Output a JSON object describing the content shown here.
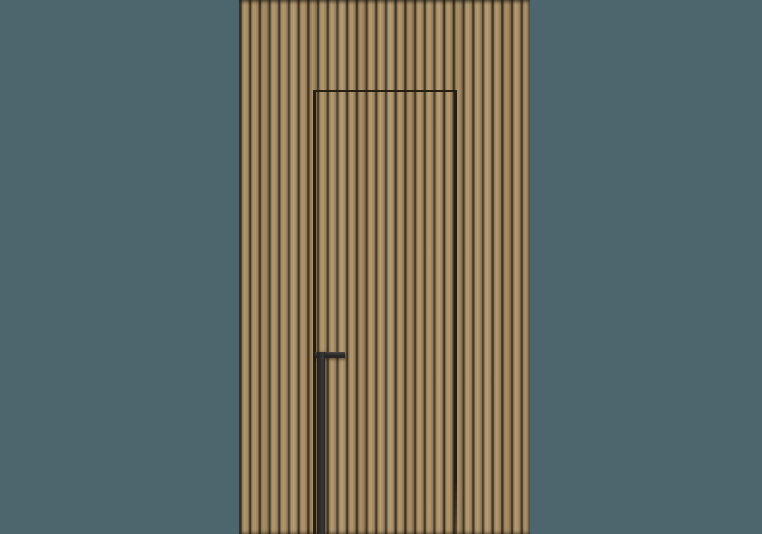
{
  "meta": {
    "description": "Product render of a concealed flush interior door clad in vertical wood slats, with a full-height matte black handle profile, set in a wood slat wall panel on a plain slate-teal background"
  },
  "colors": {
    "wall_background": "#4d666d",
    "wood_light": "#b2976d",
    "wood_base": "#a3885e",
    "wood_dark": "#8a7150",
    "groove_mid": "#7a6749",
    "groove_dark": "#3e3320",
    "door_seam": "#251e12",
    "handle_body": "#2e2d2b",
    "handle_highlight": "#4a4845"
  }
}
